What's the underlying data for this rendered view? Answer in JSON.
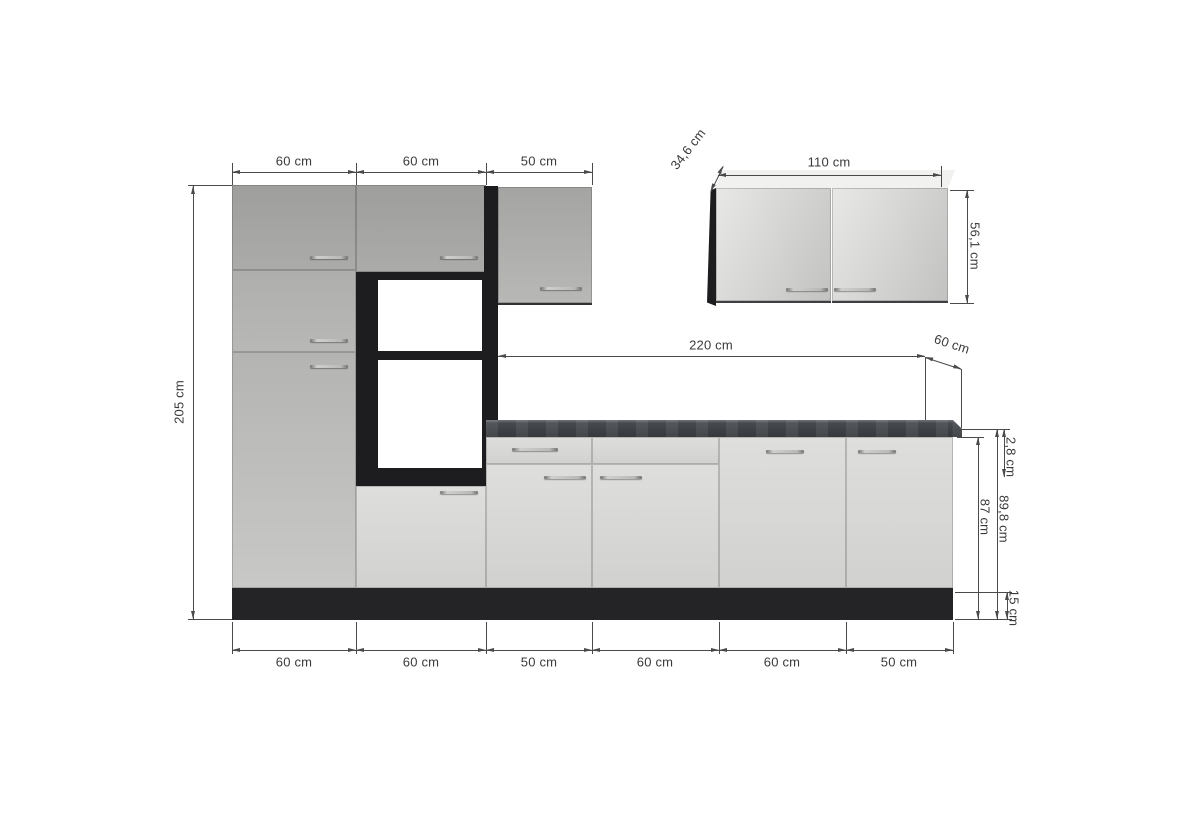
{
  "dimensions": {
    "top_row": [
      "60 cm",
      "60 cm",
      "50 cm"
    ],
    "bottom_row": [
      "60 cm",
      "60 cm",
      "50 cm",
      "60 cm",
      "60 cm",
      "50 cm"
    ],
    "total_height": "205 cm",
    "worktop_length": "220 cm",
    "worktop_depth": "60 cm",
    "worktop_thickness": "2,8 cm",
    "base_height_with_worktop": "89,8 cm",
    "base_carcass_height": "87 cm",
    "plinth_height": "15 cm",
    "wall_cabinet_width": "110 cm",
    "wall_cabinet_height": "56,1 cm",
    "wall_cabinet_depth": "34,6 cm"
  },
  "colors": {
    "background": "#ffffff",
    "front_light": "#d6d6d4",
    "front_dark": "#a6a6a4",
    "carcass_dark": "#1d1d1f",
    "plinth": "#242427",
    "worktop": "#3e4146",
    "dimension_line": "#4a4a4a",
    "dimension_text": "#3a3a3a"
  }
}
